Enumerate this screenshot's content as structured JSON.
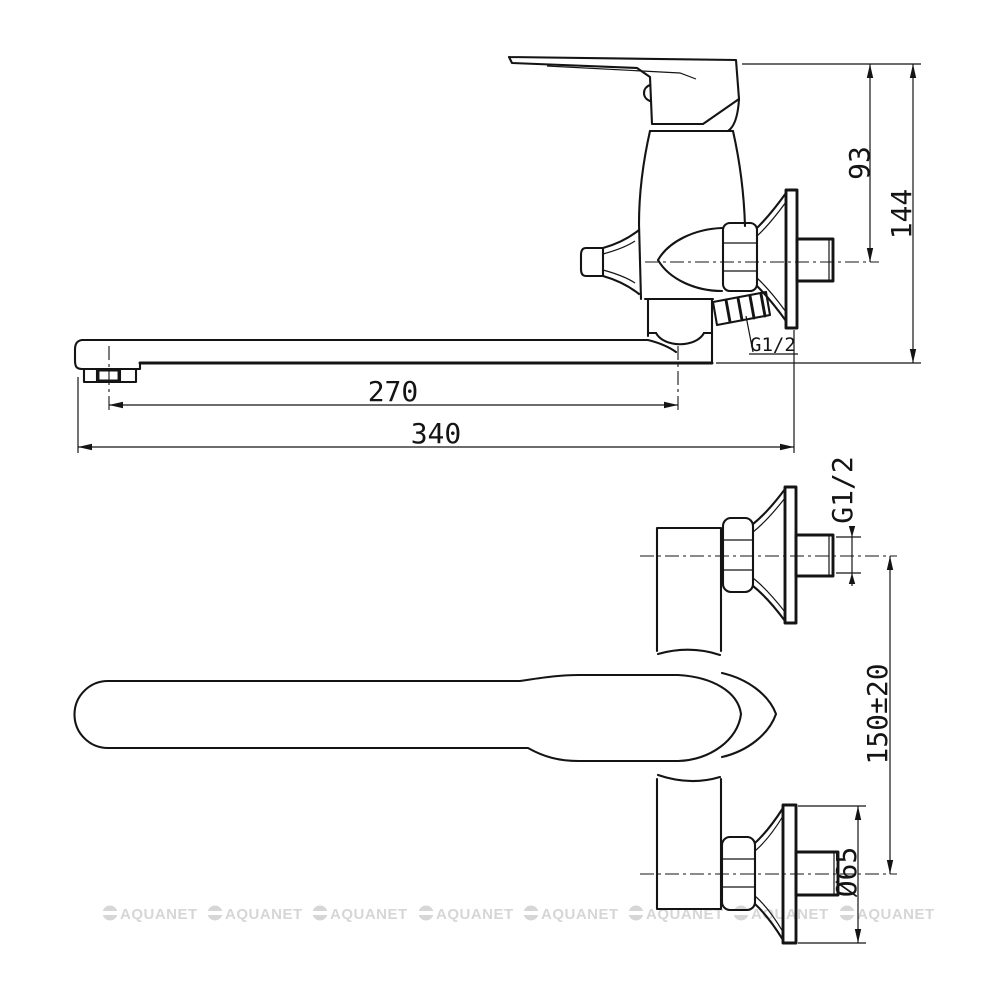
{
  "colors": {
    "line": "#141414",
    "background": "#ffffff",
    "watermark": "#d6d6d6"
  },
  "watermark": {
    "text": "AQUANET"
  },
  "side_view": {
    "name": "side-elevation-of-wall-mounted-faucet",
    "dims": {
      "spout_reach": "270",
      "total_length": "340",
      "axis_height": "93",
      "total_height": "144",
      "shower_outlet_thread": "G1/2"
    }
  },
  "plan_view": {
    "name": "plan-view-of-wall-mounted-faucet",
    "dims": {
      "inlet_thread": "G1/2",
      "inlet_spacing": "150±20",
      "flange_diameter": "Ø65"
    }
  }
}
